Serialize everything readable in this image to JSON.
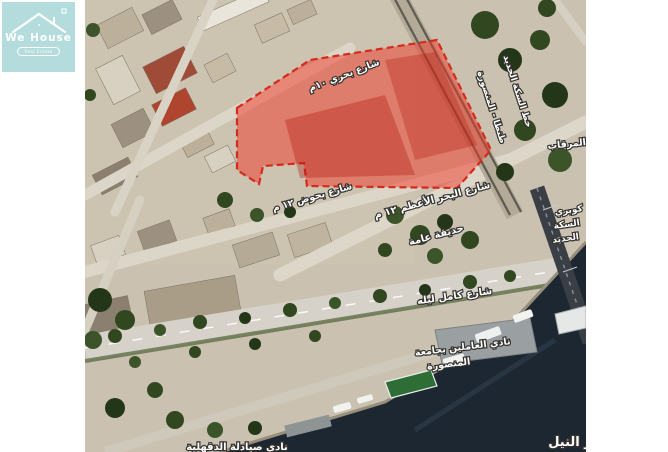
{
  "logo": {
    "title": "We House",
    "tagline": "Real Estate",
    "bg_color": "#b5dcdc"
  },
  "map": {
    "highlight_color": "#e8261a",
    "water_color": "#1d2731",
    "labels": [
      {
        "id": "street-bahary",
        "text": "شارع بحري ١٠م"
      },
      {
        "id": "railway-line",
        "text": "خط السكة الحديد"
      },
      {
        "id": "railway-route",
        "text": "طنطا - المنصورة"
      },
      {
        "id": "almarqab",
        "text": "المرقاب"
      },
      {
        "id": "street-bahoud",
        "text": "شارع بحوض ١٢ م"
      },
      {
        "id": "street-bahr-alazam",
        "text": "شارع البحر الأعظم ١٢ م"
      },
      {
        "id": "public-garden",
        "text": "حديقة عامة"
      },
      {
        "id": "street-kamel-leila",
        "text": "شارع كامل ليله"
      },
      {
        "id": "university-club-line1",
        "text": "نادي العاملين بجامعة"
      },
      {
        "id": "university-club-line2",
        "text": "المنصورة"
      },
      {
        "id": "bridge-line1",
        "text": "كوبري"
      },
      {
        "id": "bridge-line2",
        "text": "السكة"
      },
      {
        "id": "bridge-line3",
        "text": "الحديد"
      },
      {
        "id": "nile-river",
        "text": "نهر النيل"
      },
      {
        "id": "pharmacists-club",
        "text": "نادي صيادلة الدقهلية"
      }
    ]
  }
}
